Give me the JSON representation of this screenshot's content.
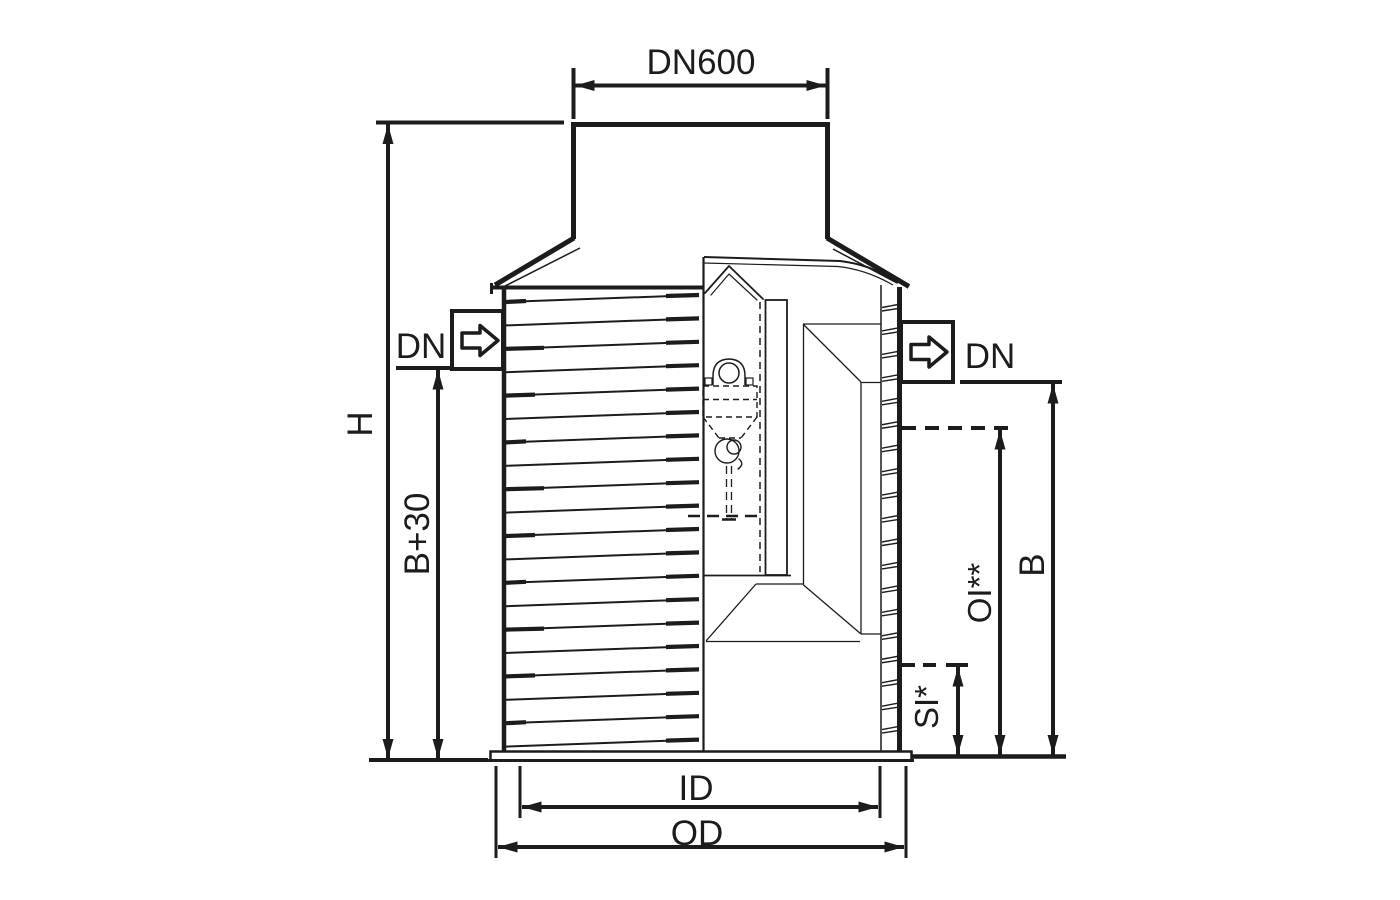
{
  "drawing": {
    "labels": {
      "neck_diameter": "DN600",
      "overall_height": "H",
      "inlet_invert_depth": "B+30",
      "inlet_nominal_size": "DN",
      "outlet_nominal_size": "DN",
      "oil_layer_level": "OI**",
      "outlet_invert_depth": "B",
      "sludge_level": "SI*",
      "inner_diameter": "ID",
      "outer_diameter": "OD"
    },
    "icons": {
      "inlet_flow_icon": "block-arrow-right",
      "outlet_flow_icon": "block-arrow-right"
    },
    "colors": {
      "line": "#1c1c1c",
      "background": "#ffffff"
    }
  }
}
